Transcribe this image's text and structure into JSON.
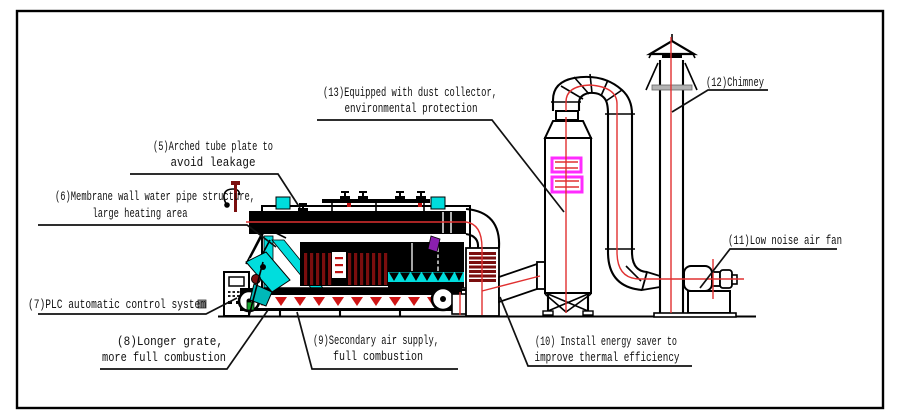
{
  "diagram": {
    "title": "chain grate boiler plant schematic",
    "labels": {
      "5": {
        "line1": "(5)Arched tube plate to",
        "line2": "avoid leakage"
      },
      "6": {
        "line1": "(6)Membrane wall water pipe structure,",
        "line2": "large heating area"
      },
      "7": {
        "line1": "(7)PLC automatic control system"
      },
      "8": {
        "line1": "(8)Longer grate,",
        "line2": "more full combustion"
      },
      "9": {
        "line1": "(9)Secondary air supply,",
        "line2": "full combustion"
      },
      "10": {
        "line1": "(10) Install energy saver to",
        "line2": "improve thermal efficiency"
      },
      "11": {
        "line1": "(11)Low noise air fan"
      },
      "12": {
        "line1": "(12)Chimney"
      },
      "13": {
        "line1": "(13)Equipped with dust collector,",
        "line2": "environmental protection"
      }
    },
    "colors": {
      "background": "#ffffff",
      "line_black": "#000000",
      "centerline_red": "#e03030",
      "water_wall_cyan": "#00dddd",
      "tube_dark_red": "#7b0e0e",
      "louver_magenta": "#ff2bff",
      "grate_arrow_red": "#cf1515",
      "accent_purple": "#8a1fae",
      "accent_green": "#18a52f",
      "band_gray": "#b3b3b3"
    }
  }
}
